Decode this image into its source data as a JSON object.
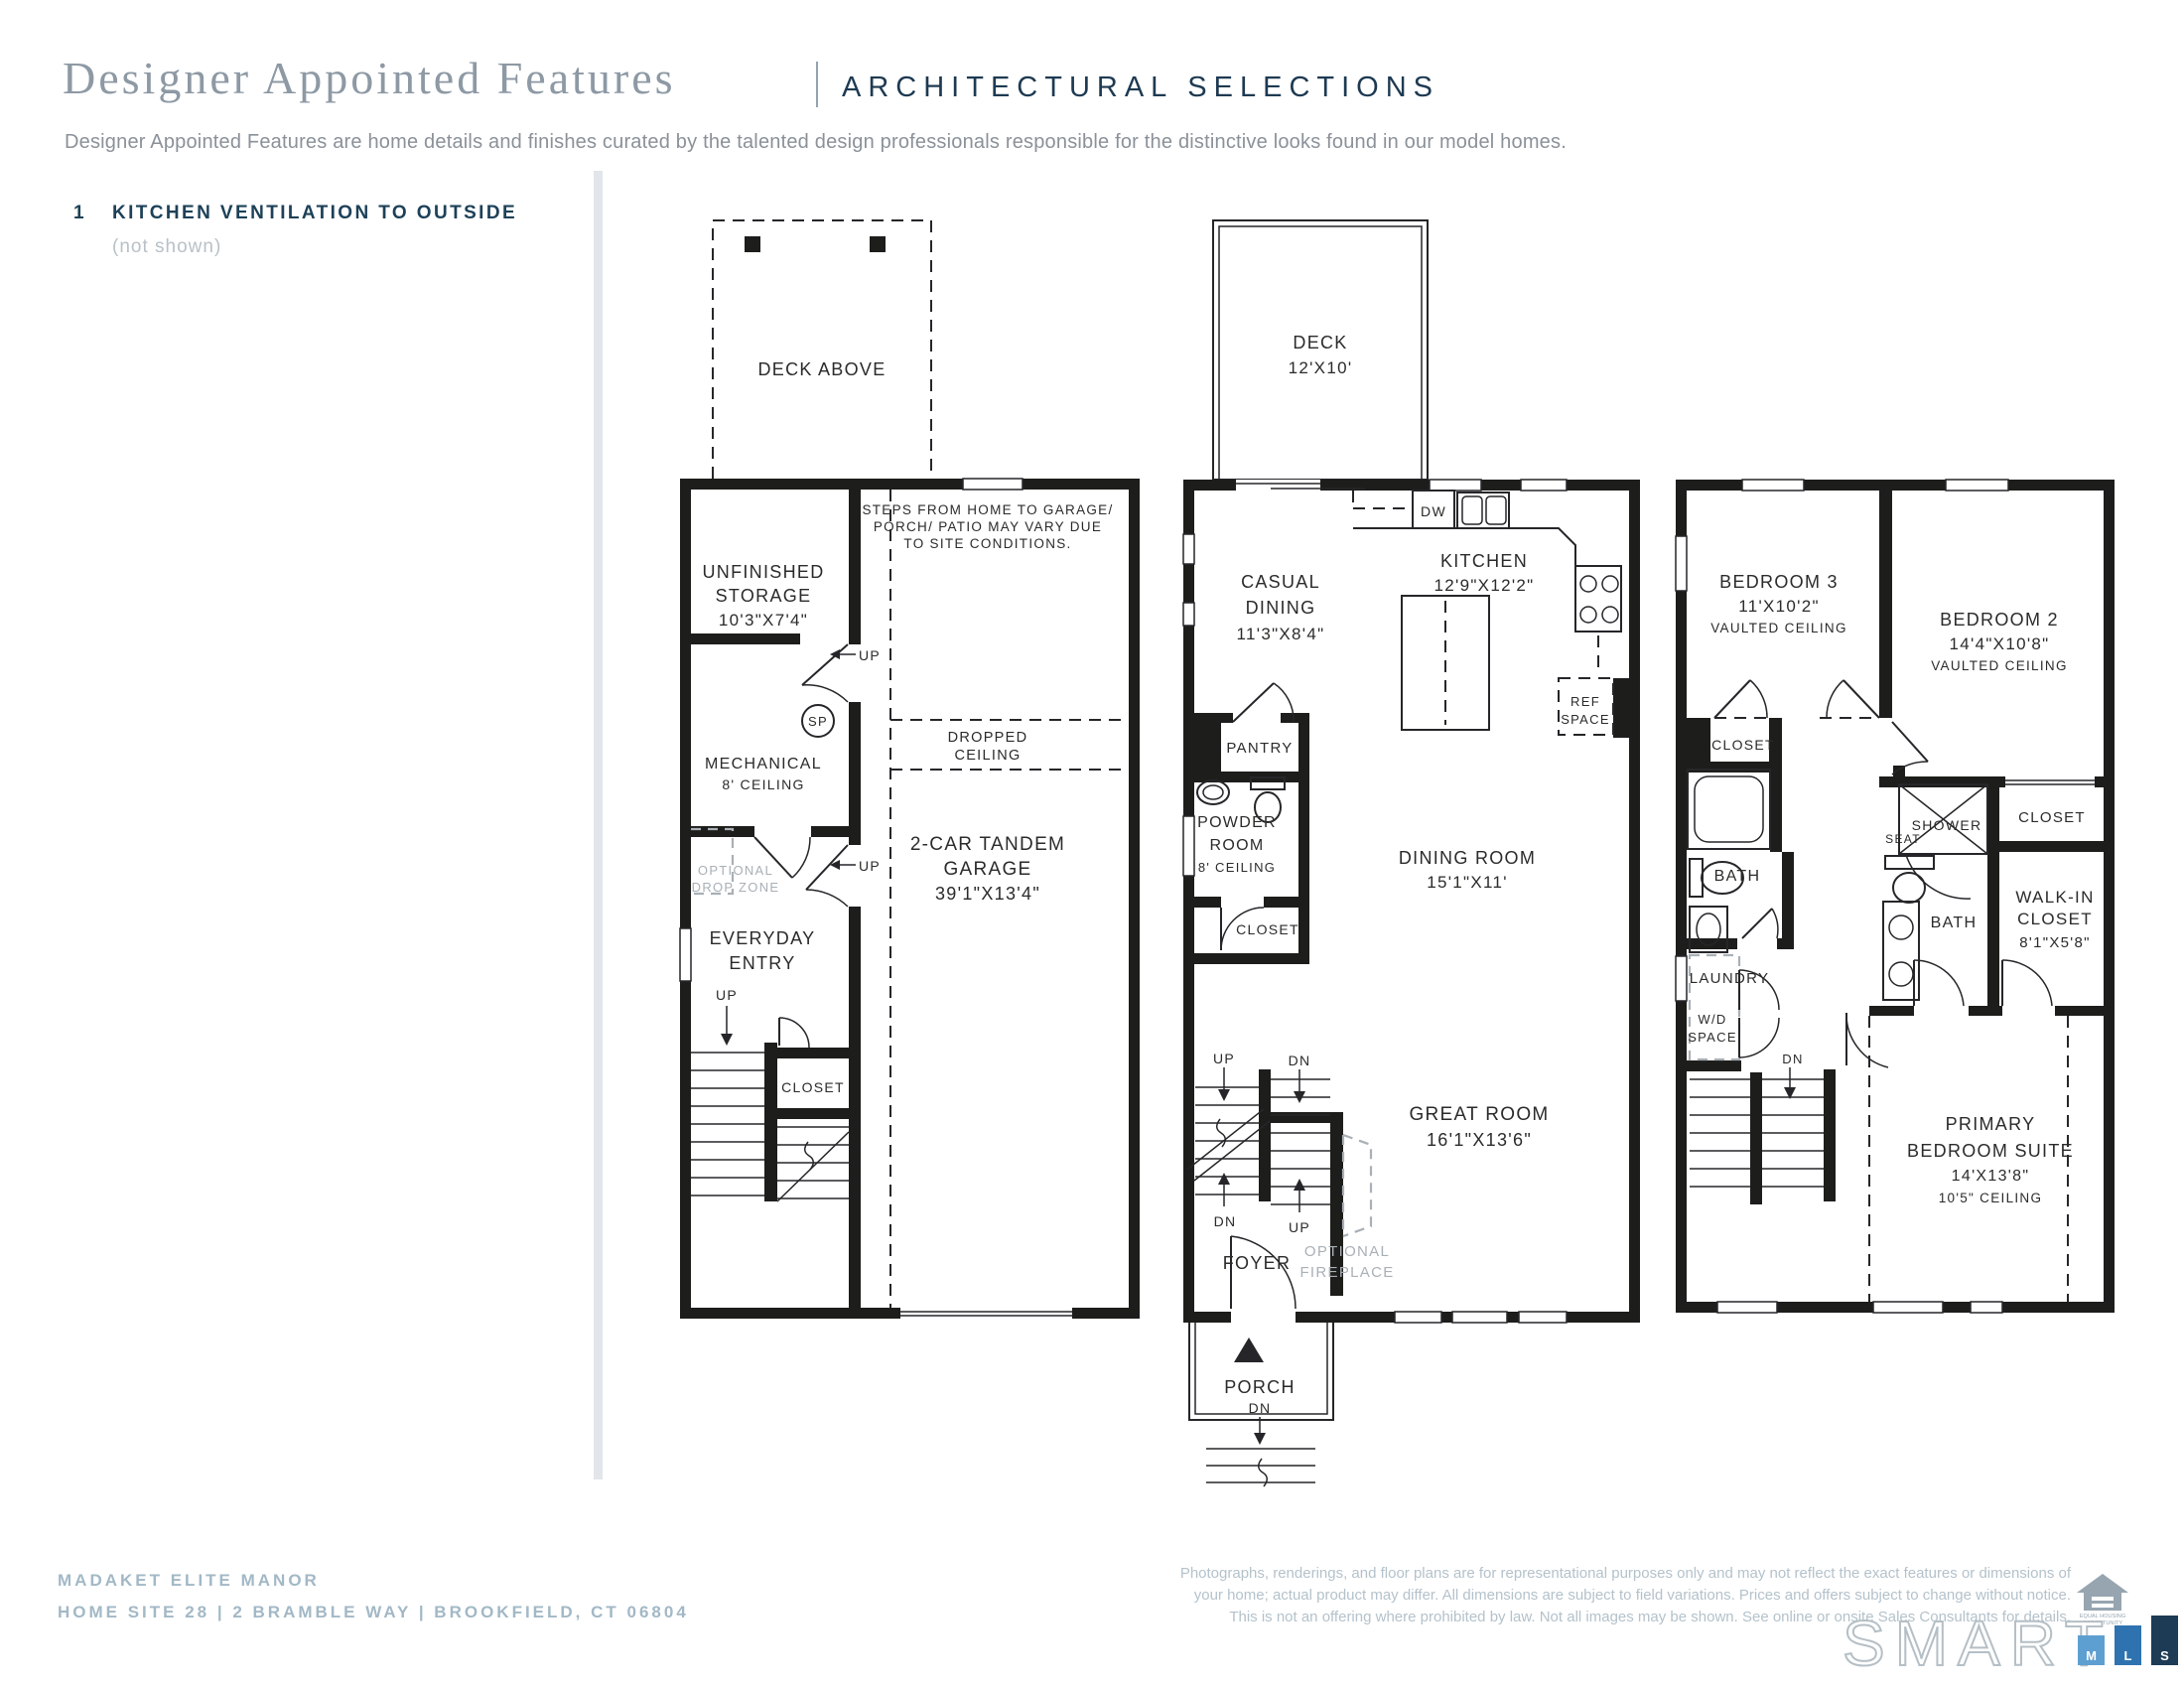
{
  "header": {
    "title": "Designer Appointed Features",
    "section": "ARCHITECTURAL SELECTIONS",
    "tagline": "Designer Appointed Features are home details and finishes curated by the talented design professionals responsible for the distinctive looks found in our model homes."
  },
  "features": {
    "num": "1",
    "title": "KITCHEN VENTILATION TO OUTSIDE",
    "note": "(not shown)"
  },
  "plan1": {
    "deck_above": "DECK ABOVE",
    "storage1": "UNFINISHED",
    "storage2": "STORAGE",
    "storage_dim": "10'3\"X7'4\"",
    "note1": "STEPS FROM HOME TO GARAGE/",
    "note2": "PORCH/ PATIO MAY VARY DUE",
    "note3": "TO SITE CONDITIONS.",
    "up_storage": "UP",
    "sp": "SP",
    "mech1": "MECHANICAL",
    "mech2": "8' CEILING",
    "dc1": "DROPPED",
    "dc2": "CEILING",
    "dz1": "OPTIONAL",
    "dz2": "DROP ZONE",
    "up_entry": "UP",
    "entry1": "EVERYDAY",
    "entry2": "ENTRY",
    "up_stairs": "UP",
    "closet": "CLOSET",
    "garage1": "2-CAR TANDEM",
    "garage2": "GARAGE",
    "garage_dim": "39'1\"X13'4\""
  },
  "plan2": {
    "deck": "DECK",
    "deck_dim": "12'X10'",
    "dw": "DW",
    "kitchen": "KITCHEN",
    "kitchen_dim": "12'9\"X12'2\"",
    "casual1": "CASUAL",
    "casual2": "DINING",
    "casual_dim": "11'3\"X8'4\"",
    "pantry": "PANTRY",
    "powder1": "POWDER",
    "powder2": "ROOM",
    "powder3": "8' CEILING",
    "ref1": "REF",
    "ref2": "SPACE",
    "closet": "CLOSET",
    "dining": "DINING ROOM",
    "dining_dim": "15'1\"X11'",
    "up_top": "UP",
    "dn_top": "DN",
    "dn_bot": "DN",
    "up_bot": "UP",
    "great": "GREAT ROOM",
    "great_dim": "16'1\"X13'6\"",
    "fp1": "OPTIONAL",
    "fp2": "FIREPLACE",
    "foyer": "FOYER",
    "porch": "PORCH",
    "porch_dn": "DN"
  },
  "plan3": {
    "bed3": "BEDROOM 3",
    "bed3_dim": "11'X10'2\"",
    "bed3_note": "VAULTED CEILING",
    "bed2": "BEDROOM 2",
    "bed2_dim": "14'4\"X10'8\"",
    "bed2_note": "VAULTED CEILING",
    "closet3": "CLOSET",
    "bath1": "BATH",
    "shower": "SHOWER",
    "seat": "SEAT",
    "closet2": "CLOSET",
    "bath2": "BATH",
    "wic1": "WALK-IN",
    "wic2": "CLOSET",
    "wic_dim": "8'1\"X5'8\"",
    "laundry": "LAUNDRY",
    "wd1": "W/D",
    "wd2": "SPACE",
    "dn": "DN",
    "primary1": "PRIMARY",
    "primary2": "BEDROOM SUITE",
    "primary_dim": "14'X13'8\"",
    "primary_note": "10'5\" CEILING"
  },
  "footer": {
    "community": "MADAKET ELITE MANOR",
    "address": "HOME SITE 28   |   2 BRAMBLE WAY   |   BROOKFIELD, CT 06804",
    "disclaimer1": "Photographs, renderings, and floor plans are for representational purposes only and may not reflect the exact features or dimensions of",
    "disclaimer2": "your home; actual product may differ. All dimensions are subject to field variations. Prices and offers subject to change without notice.",
    "disclaimer3": "This is not an offering where prohibited by law. Not all images may be shown. See online or onsite Sales Consultants for details.",
    "eho1": "EQUAL HOUSING",
    "eho2": "OPPORTUNITY",
    "smart": "SMART",
    "mls_m": "M",
    "mls_l": "L",
    "mls_s": "S"
  },
  "colors": {
    "navy": "#1e3a52",
    "title_gray": "#8d99a4",
    "footer_blue": "#a2b8c6",
    "plan_line": "#1d1d1b",
    "muted_gray": "#a9b0b6",
    "mls_light": "#5E9FD1",
    "mls_mid": "#2E73B0",
    "mls_dark": "#1D3B55"
  }
}
